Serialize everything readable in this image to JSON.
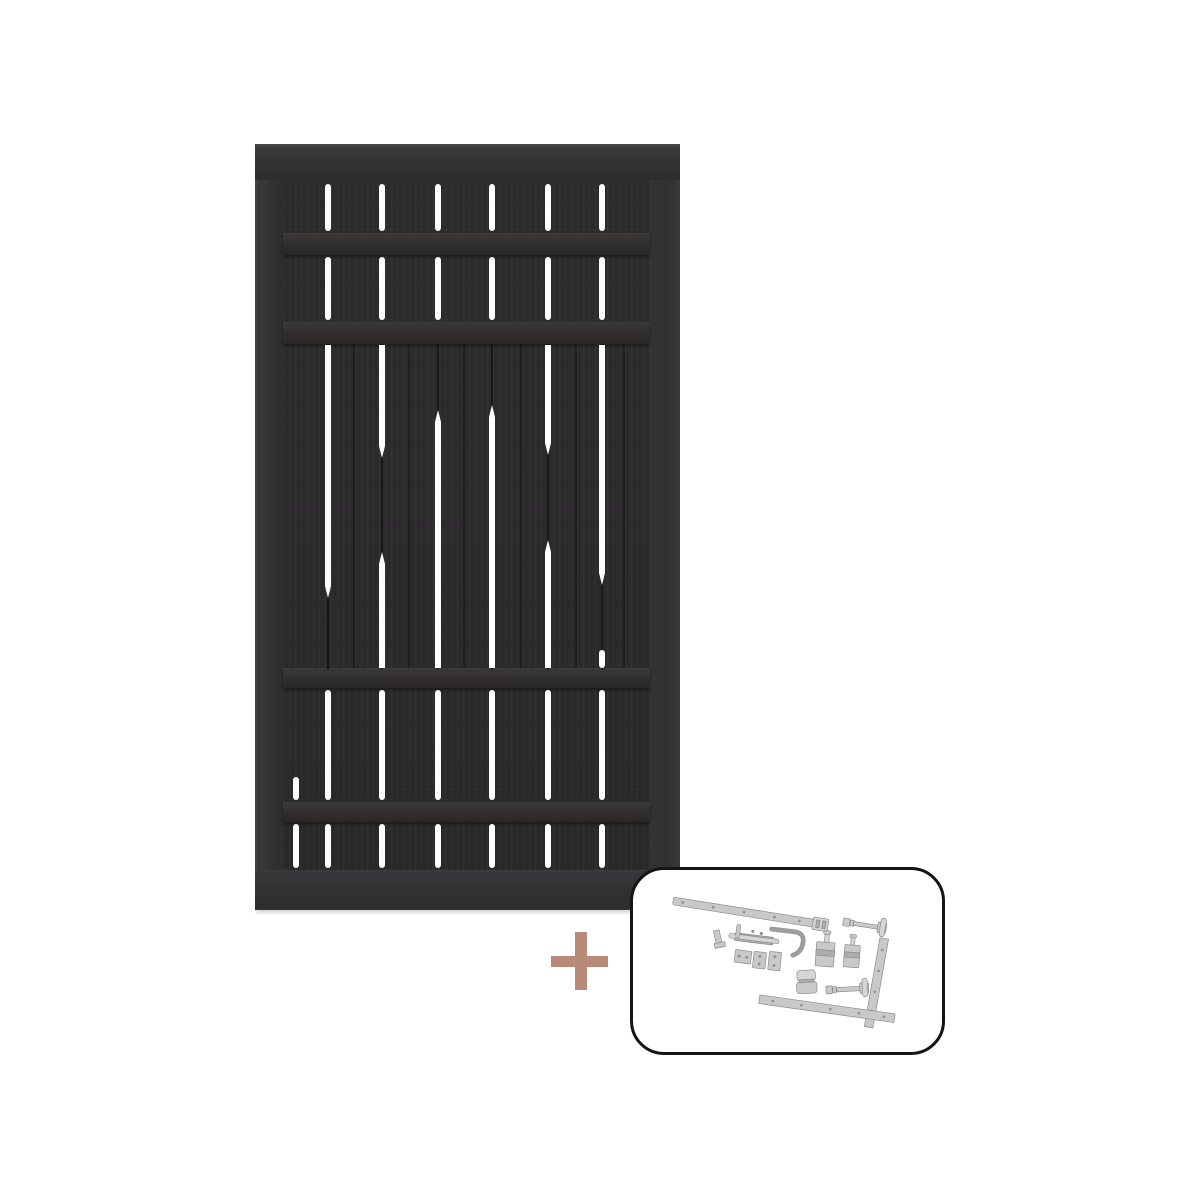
{
  "image": {
    "kind": "product-photo",
    "subject": "Black slatted wooden fence gate sold together with a galvanized steel fitting kit",
    "background_color": "#ffffff"
  },
  "gate": {
    "frame_color": "#333234",
    "board_color": "#2b2a2b",
    "batten_color": "#343231",
    "gap_color": "#fdfdfd",
    "geometry": {
      "x": 255,
      "y": 144,
      "width": 425,
      "height": 766
    },
    "battens": [
      {
        "y": 89,
        "h": 22
      },
      {
        "y": 178,
        "h": 22
      },
      {
        "y": 524,
        "h": 20
      },
      {
        "y": 658,
        "h": 20
      }
    ],
    "mid_dark_lines": [
      {
        "x": 72,
        "y": 200,
        "h": 326
      },
      {
        "x": 126,
        "y": 200,
        "h": 326
      },
      {
        "x": 182,
        "y": 200,
        "h": 326
      },
      {
        "x": 236,
        "y": 200,
        "h": 326
      },
      {
        "x": 292,
        "y": 200,
        "h": 326
      },
      {
        "x": 346,
        "y": 200,
        "h": 326
      },
      {
        "x": 98,
        "y": 200,
        "h": 324,
        "faint": true
      },
      {
        "x": 153,
        "y": 200,
        "h": 324,
        "faint": true
      },
      {
        "x": 208,
        "y": 200,
        "h": 324,
        "faint": true
      },
      {
        "x": 265,
        "y": 200,
        "h": 324,
        "faint": true
      },
      {
        "x": 320,
        "y": 200,
        "h": 324,
        "faint": true
      },
      {
        "x": 368,
        "y": 200,
        "h": 324,
        "faint": true
      }
    ],
    "slit_segments": [
      {
        "x": 70,
        "y": 40,
        "h": 47
      },
      {
        "x": 124,
        "y": 40,
        "h": 47
      },
      {
        "x": 180,
        "y": 40,
        "h": 47
      },
      {
        "x": 234,
        "y": 40,
        "h": 47
      },
      {
        "x": 290,
        "y": 40,
        "h": 47
      },
      {
        "x": 344,
        "y": 40,
        "h": 47
      },
      {
        "x": 70,
        "y": 113,
        "h": 63
      },
      {
        "x": 124,
        "y": 113,
        "h": 63
      },
      {
        "x": 180,
        "y": 113,
        "h": 63
      },
      {
        "x": 234,
        "y": 113,
        "h": 63
      },
      {
        "x": 290,
        "y": 113,
        "h": 63
      },
      {
        "x": 344,
        "y": 113,
        "h": 63
      },
      {
        "x": 70,
        "y": 201,
        "h": 253,
        "tip": "bottom"
      },
      {
        "x": 124,
        "y": 201,
        "h": 113,
        "tip": "bottom"
      },
      {
        "x": 124,
        "y": 408,
        "h": 116,
        "tip": "top"
      },
      {
        "x": 180,
        "y": 266,
        "h": 258,
        "tip": "top"
      },
      {
        "x": 234,
        "y": 261,
        "h": 263,
        "tip": "top"
      },
      {
        "x": 290,
        "y": 201,
        "h": 110,
        "tip": "bottom"
      },
      {
        "x": 290,
        "y": 396,
        "h": 128,
        "tip": "top"
      },
      {
        "x": 344,
        "y": 201,
        "h": 240,
        "tip": "bottom"
      },
      {
        "x": 344,
        "y": 506,
        "h": 18
      },
      {
        "x": 70,
        "y": 546,
        "h": 110
      },
      {
        "x": 124,
        "y": 546,
        "h": 110
      },
      {
        "x": 180,
        "y": 546,
        "h": 110
      },
      {
        "x": 234,
        "y": 546,
        "h": 110
      },
      {
        "x": 290,
        "y": 546,
        "h": 110
      },
      {
        "x": 344,
        "y": 546,
        "h": 110
      },
      {
        "x": 38,
        "y": 633,
        "h": 23
      },
      {
        "x": 70,
        "y": 680,
        "h": 44
      },
      {
        "x": 124,
        "y": 680,
        "h": 44
      },
      {
        "x": 180,
        "y": 680,
        "h": 44
      },
      {
        "x": 234,
        "y": 680,
        "h": 44
      },
      {
        "x": 290,
        "y": 680,
        "h": 44
      },
      {
        "x": 344,
        "y": 680,
        "h": 44
      },
      {
        "x": 38,
        "y": 680,
        "h": 44
      }
    ]
  },
  "plus_sign": {
    "symbol": "+",
    "color": "#b78a7a"
  },
  "hardware_kit": {
    "panel_border_color": "#141414",
    "panel_background": "#ffffff",
    "metal_color": "#c9c9c9",
    "metal_edge_color": "#8a8a8a",
    "items": [
      "long hinge strap with knuckle",
      "hinge pin bolt",
      "corner clip",
      "drop bolt",
      "handle hook",
      "hinge pin block",
      "hinge pin block",
      "keeper plate",
      "keeper plate",
      "keeper plate",
      "spring clip",
      "hinge pin bolt",
      "L-shaped hinge strap"
    ]
  }
}
